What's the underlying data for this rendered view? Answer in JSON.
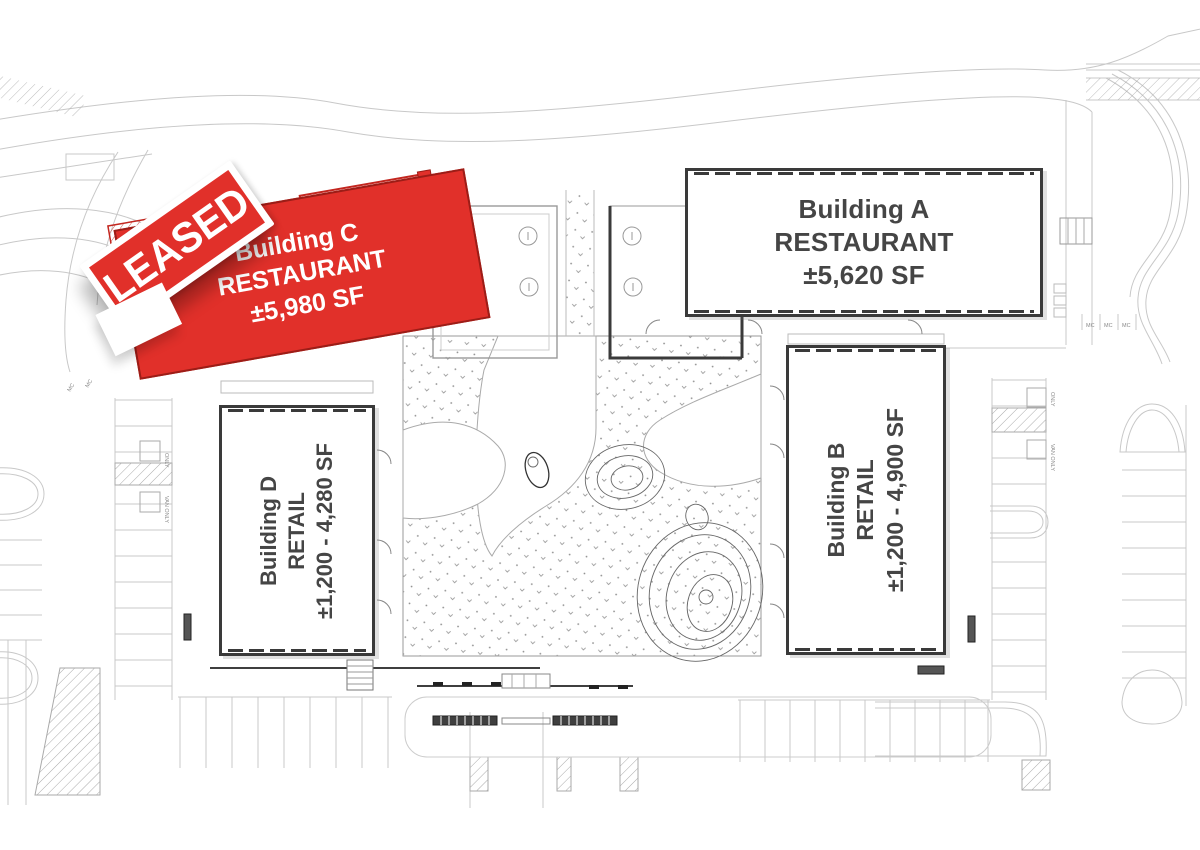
{
  "buildings": [
    {
      "id": "A",
      "name": "Building A",
      "use": "RESTAURANT",
      "size": "±5,620 SF",
      "leased": false
    },
    {
      "id": "B",
      "name": "Building B",
      "use": "RETAIL",
      "size": "±1,200 - 4,900 SF",
      "leased": false
    },
    {
      "id": "C",
      "name": "Building C",
      "use": "RESTAURANT",
      "size": "±5,980 SF",
      "leased": true
    },
    {
      "id": "D",
      "name": "Building D",
      "use": "RETAIL",
      "size": "±1,200 - 4,280 SF",
      "leased": false
    }
  ],
  "stamp": {
    "label": "LEASED"
  },
  "parking_labels": {
    "mc": "MC",
    "only": "ONLY",
    "van_only": "VAN ONLY"
  },
  "colors": {
    "leased_red": "#e1302a",
    "building_outline": "#3a3a3a",
    "text_dark": "#454545",
    "line_light": "#c8c8c8",
    "line_mid": "#999999"
  }
}
